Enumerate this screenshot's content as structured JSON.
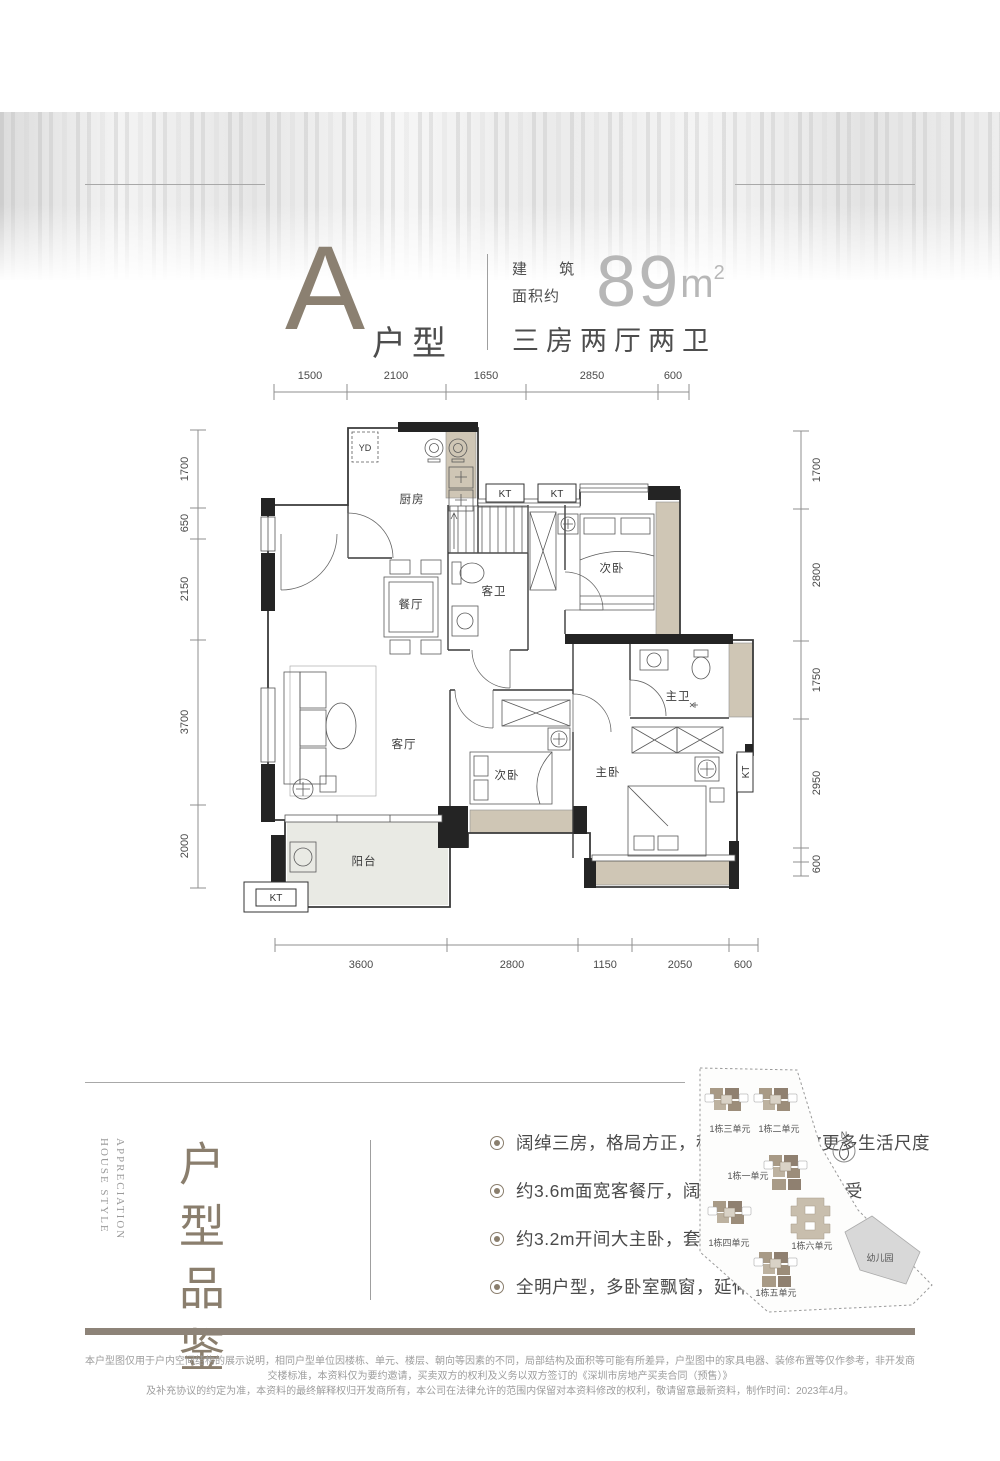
{
  "header": {
    "type_letter": "A",
    "type_suffix": "户型",
    "area_label_line1": "建 筑",
    "area_label_line2": "面积约",
    "area_value": "89",
    "area_unit": "m",
    "area_sup": "2",
    "layout_text": "三房两厅两卫"
  },
  "floorplan": {
    "dims_top": [
      "1500",
      "2100",
      "1650",
      "2850",
      "600"
    ],
    "dims_bottom": [
      "3600",
      "2800",
      "1150",
      "2050",
      "600"
    ],
    "dims_left": [
      "1700",
      "650",
      "2150",
      "3700",
      "2000"
    ],
    "dims_right": [
      "1700",
      "2800",
      "1750",
      "2950",
      "600"
    ],
    "rooms": {
      "kitchen": "厨房",
      "dining": "餐厅",
      "guest_bath": "客卫",
      "bedroom_top": "次卧",
      "living": "客厅",
      "bedroom_mid": "次卧",
      "master_bath": "主卫",
      "master_bedroom": "主卧",
      "balcony": "阳台"
    },
    "tags": {
      "yd": "YD",
      "kt": "KT"
    }
  },
  "features": {
    "title_en_line1": "HOUSE STYLE",
    "title_en_line2": "APPRECIATION",
    "title_cn": "户型品鉴",
    "bullets": [
      "阔绰三房，格局方正，科学布局，释放更多生活尺度",
      "约3.6m面宽客餐厅，阔绰空间感，难得享受",
      "约3.2m开间大主卧，套房设计，奢享朗阔生活",
      "全明户型，多卧室飘窗，延伸空间尺度"
    ]
  },
  "sitemap": {
    "buildings": [
      "1栋三单元",
      "1栋二单元",
      "1栋一单元",
      "1栋四单元",
      "1栋六单元",
      "1栋五单元"
    ],
    "kindergarten": "幼儿园",
    "compass": "N"
  },
  "disclaimer": {
    "line1": "本户型图仅用于户内空间结构的展示说明，相同户型单位因楼栋、单元、楼层、朝向等因素的不同，局部结构及面积等可能有所差异，户型图中的家具电器、装修布置等仅作参考，非开发商交楼标准，本资料仅为要约邀请，买卖双方的权利及义务以双方签订的《深圳市房地产买卖合同（预售）》",
    "line2": "及补充协议的约定为准，本资料的最终解释权归开发商所有，本公司在法律允许的范围内保留对本资料修改的权利，敬请留意最新资料，制作时间：2023年4月。"
  }
}
